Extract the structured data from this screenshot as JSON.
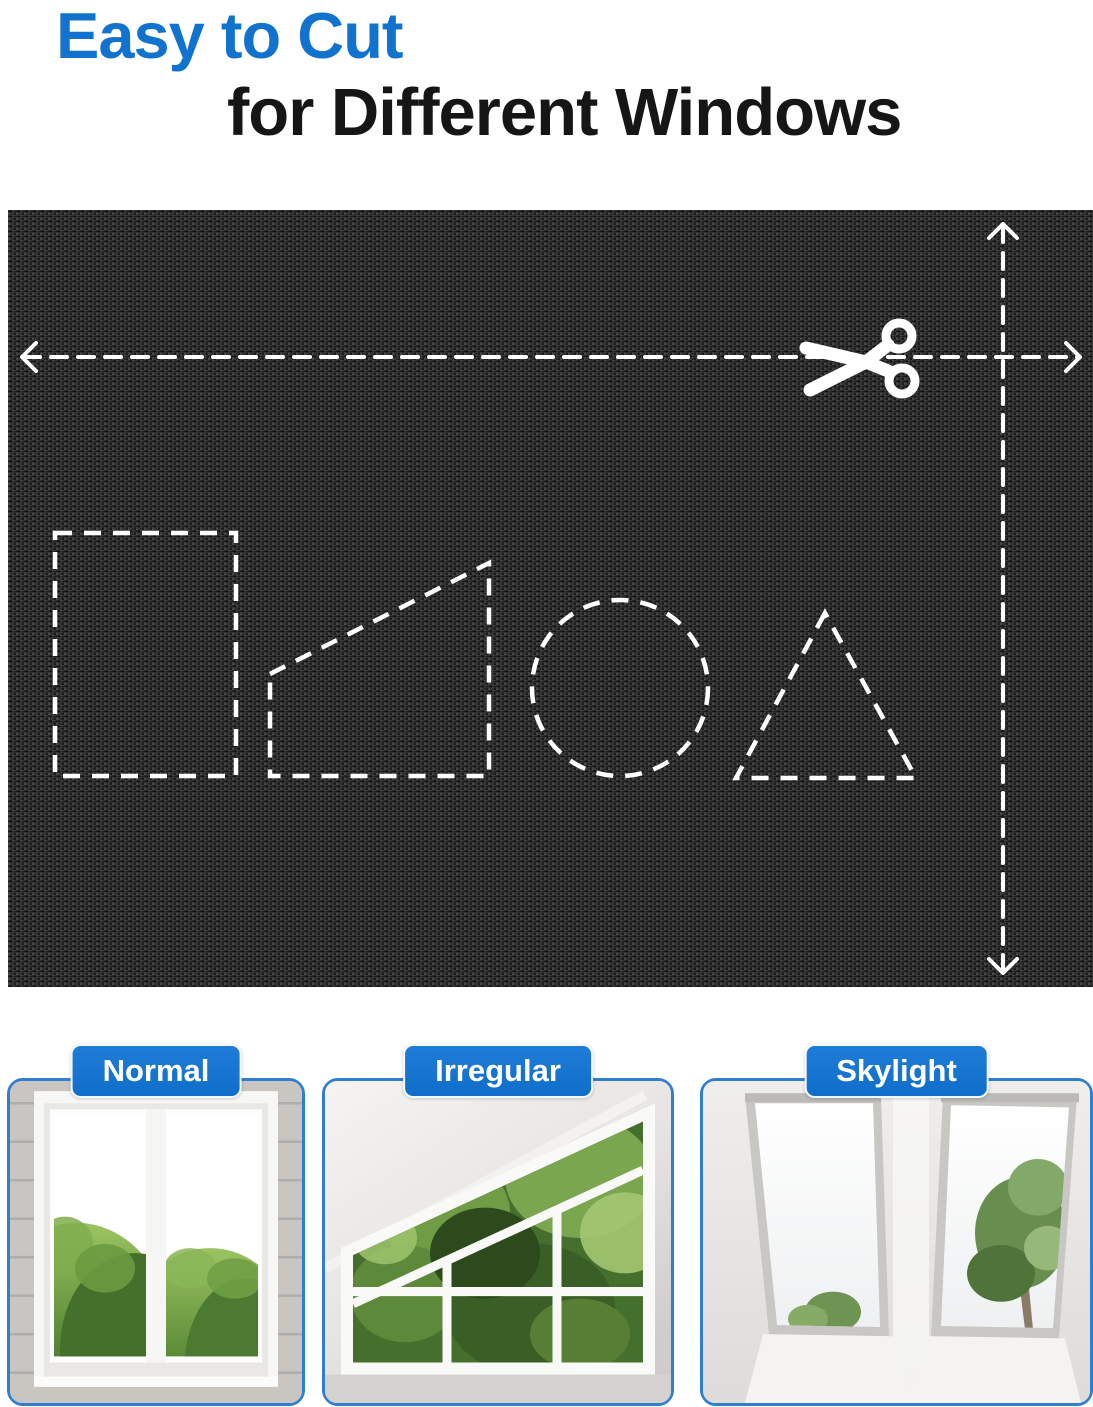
{
  "title": {
    "line1": "Easy to Cut",
    "line2": "for Different Windows"
  },
  "fabric": {
    "cut_guide_icons": [
      "scissors-icon",
      "horizontal-cut-arrow",
      "vertical-cut-arrow"
    ],
    "cut_shapes": [
      "rectangle",
      "trapezoid",
      "circle",
      "triangle"
    ]
  },
  "cards": [
    {
      "label": "Normal"
    },
    {
      "label": "Irregular"
    },
    {
      "label": "Skylight"
    }
  ],
  "colors": {
    "accent_blue": "#1273cf",
    "badge_blue": "#1174d0",
    "card_border_blue": "#2f7ecf",
    "fabric_base": "#252525",
    "cut_line_white": "#ffffff",
    "title_black": "#161616"
  }
}
